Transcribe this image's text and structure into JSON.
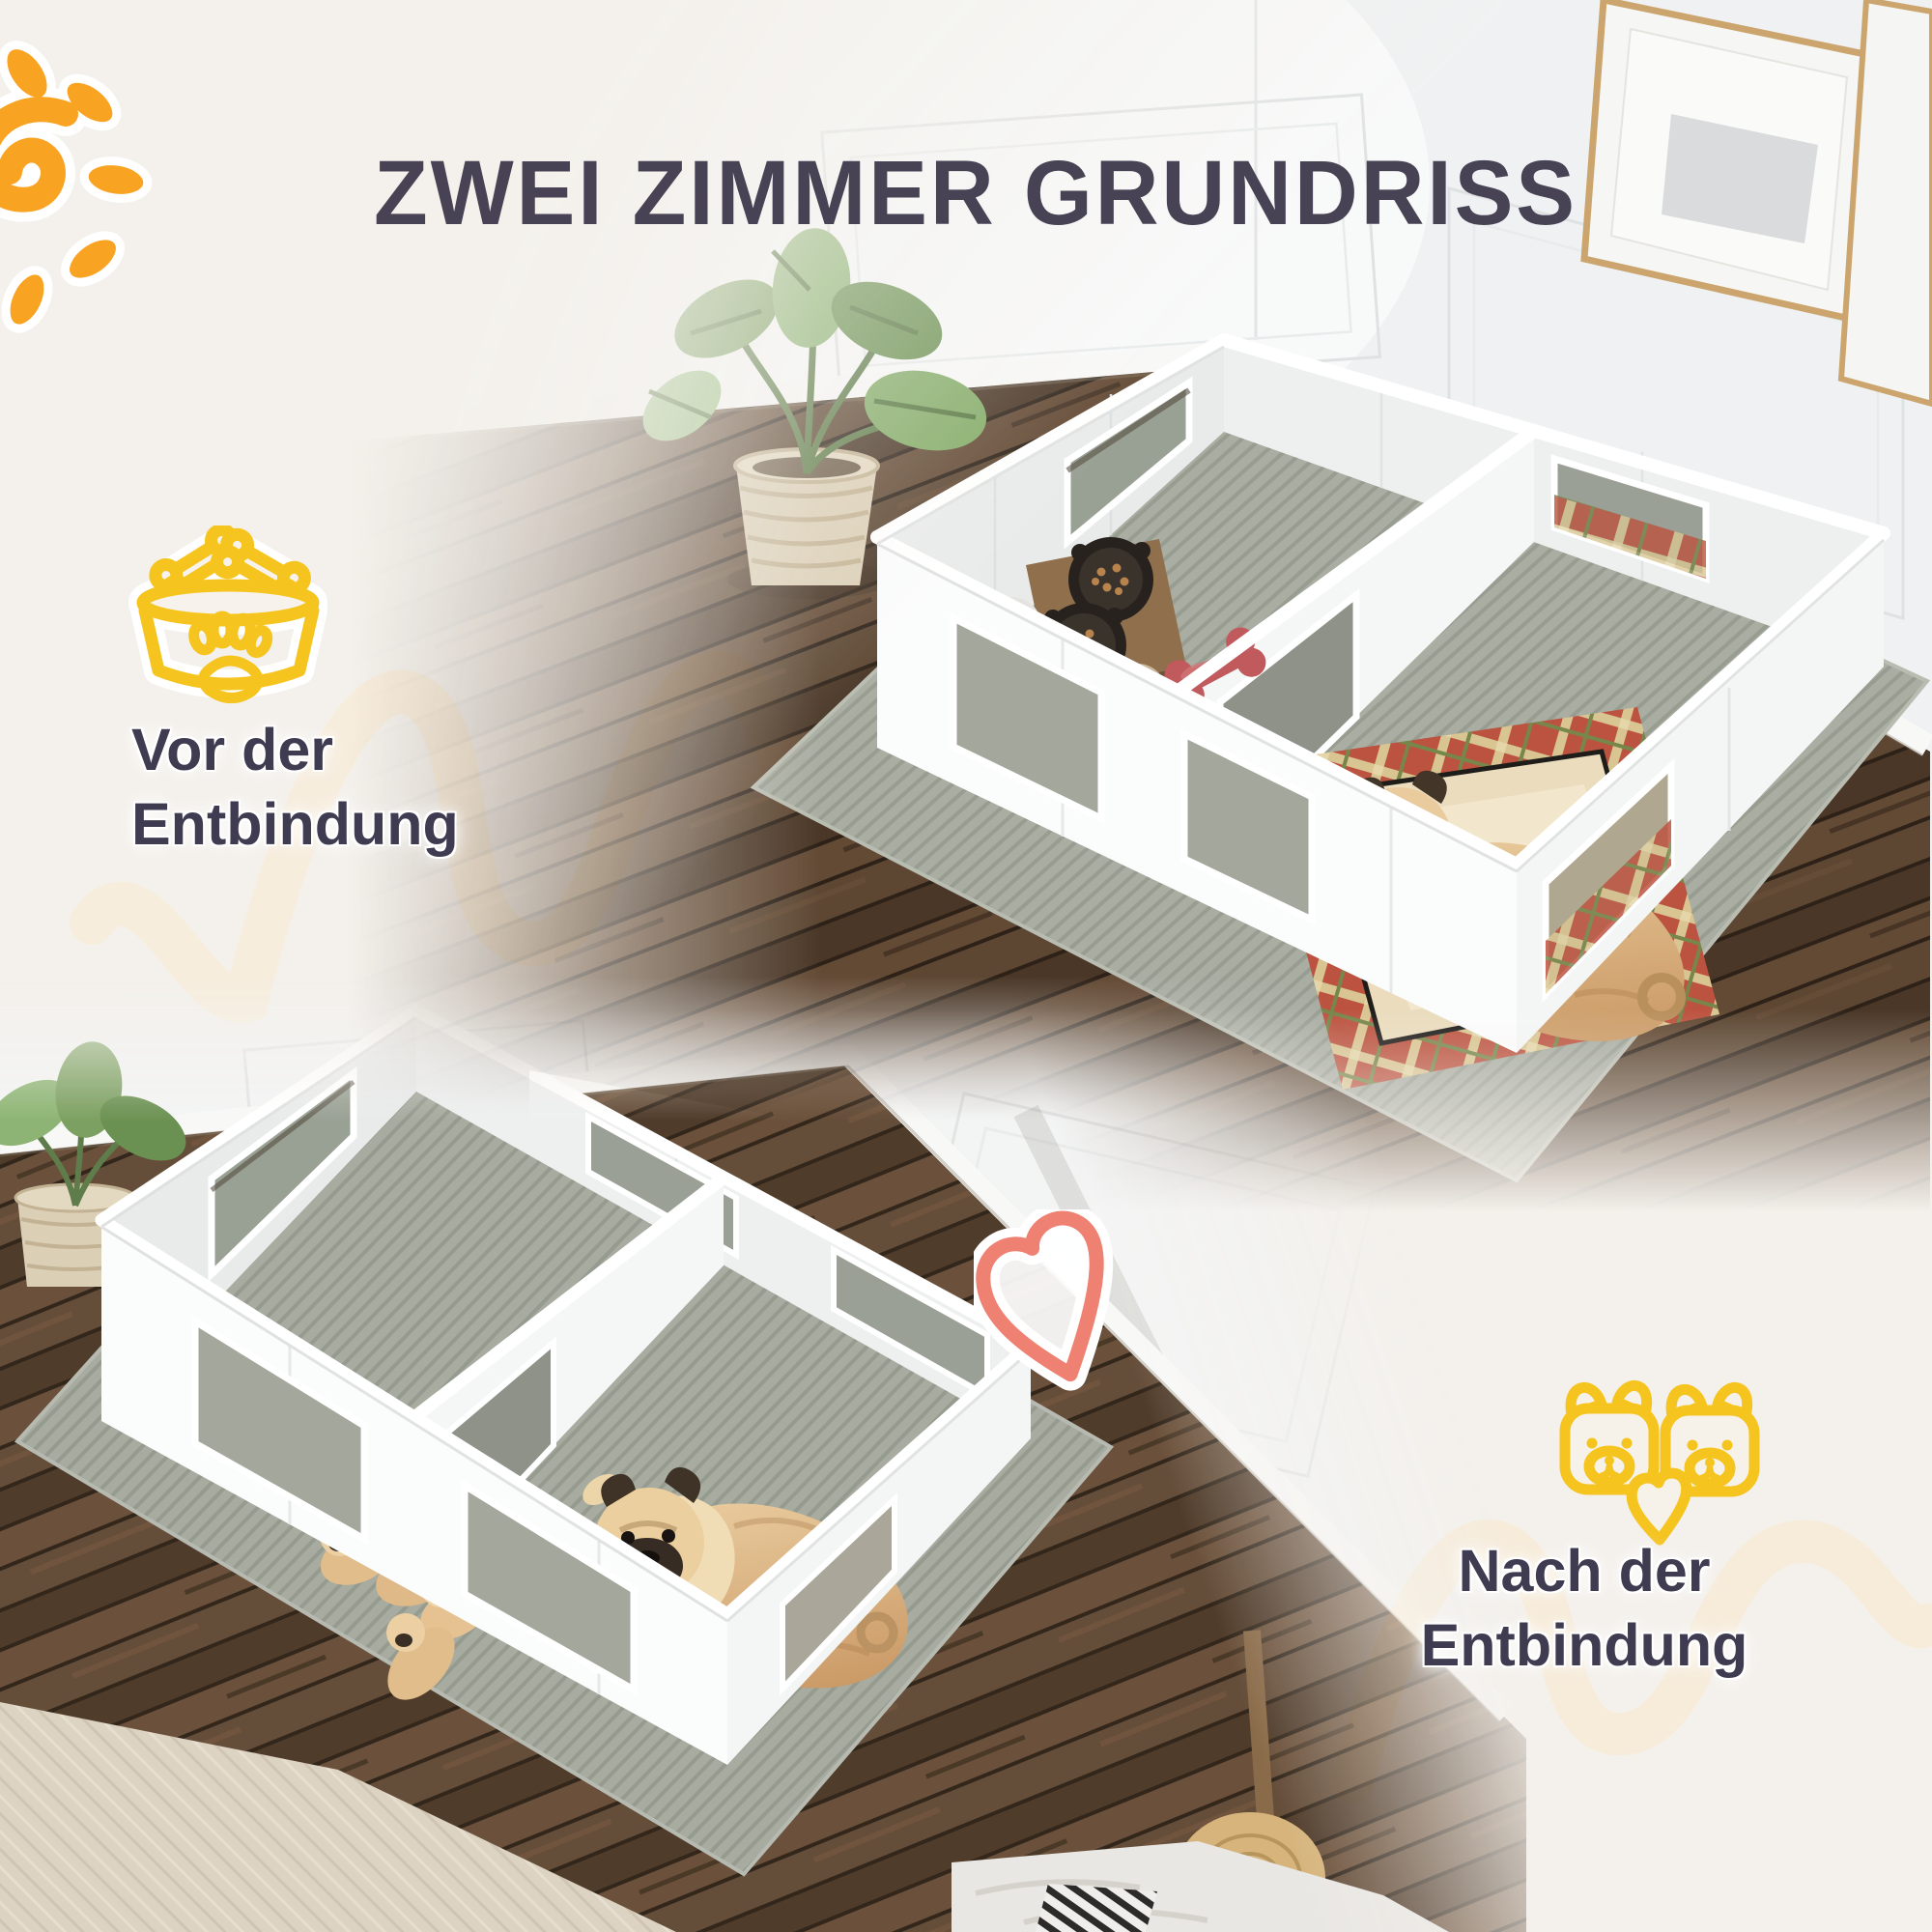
{
  "title": "ZWEI ZIMMER GRUNDRISS",
  "sections": {
    "before": {
      "line1": "Vor der",
      "line2": "Entbindung",
      "icon": "dog-bowl-icon"
    },
    "after": {
      "line1": "Nach der",
      "line2": "Entbindung",
      "icon": "dog-heads-heart-icon"
    }
  },
  "decorations": [
    "sun-icon",
    "heart-doodle-icon",
    "peach-squiggle-left",
    "peach-squiggle-right"
  ],
  "scenes": {
    "before": "mother pug resting in plaid bed inside right room of white two-room whelping pen, feeding bowls and toys in left room",
    "after": "puppies in left room and mother pug in right room of white two-room whelping pen"
  },
  "theme": {
    "background": "#f4f1ec",
    "title_color": "#474254",
    "caption_color": "#3f3b50",
    "accent_yellow": "#f5c41f",
    "accent_orange": "#f9a322",
    "accent_coral": "#ef8173",
    "squiggle_peach": "#f8ead3",
    "wall_white": "#eff1f2",
    "pen_white": "#fafbfb",
    "mat_gray": "#a9ada2",
    "wood_floor": "#54402f",
    "rug_beige": "#dcd3c3",
    "plaid_red": "#bc5340"
  }
}
